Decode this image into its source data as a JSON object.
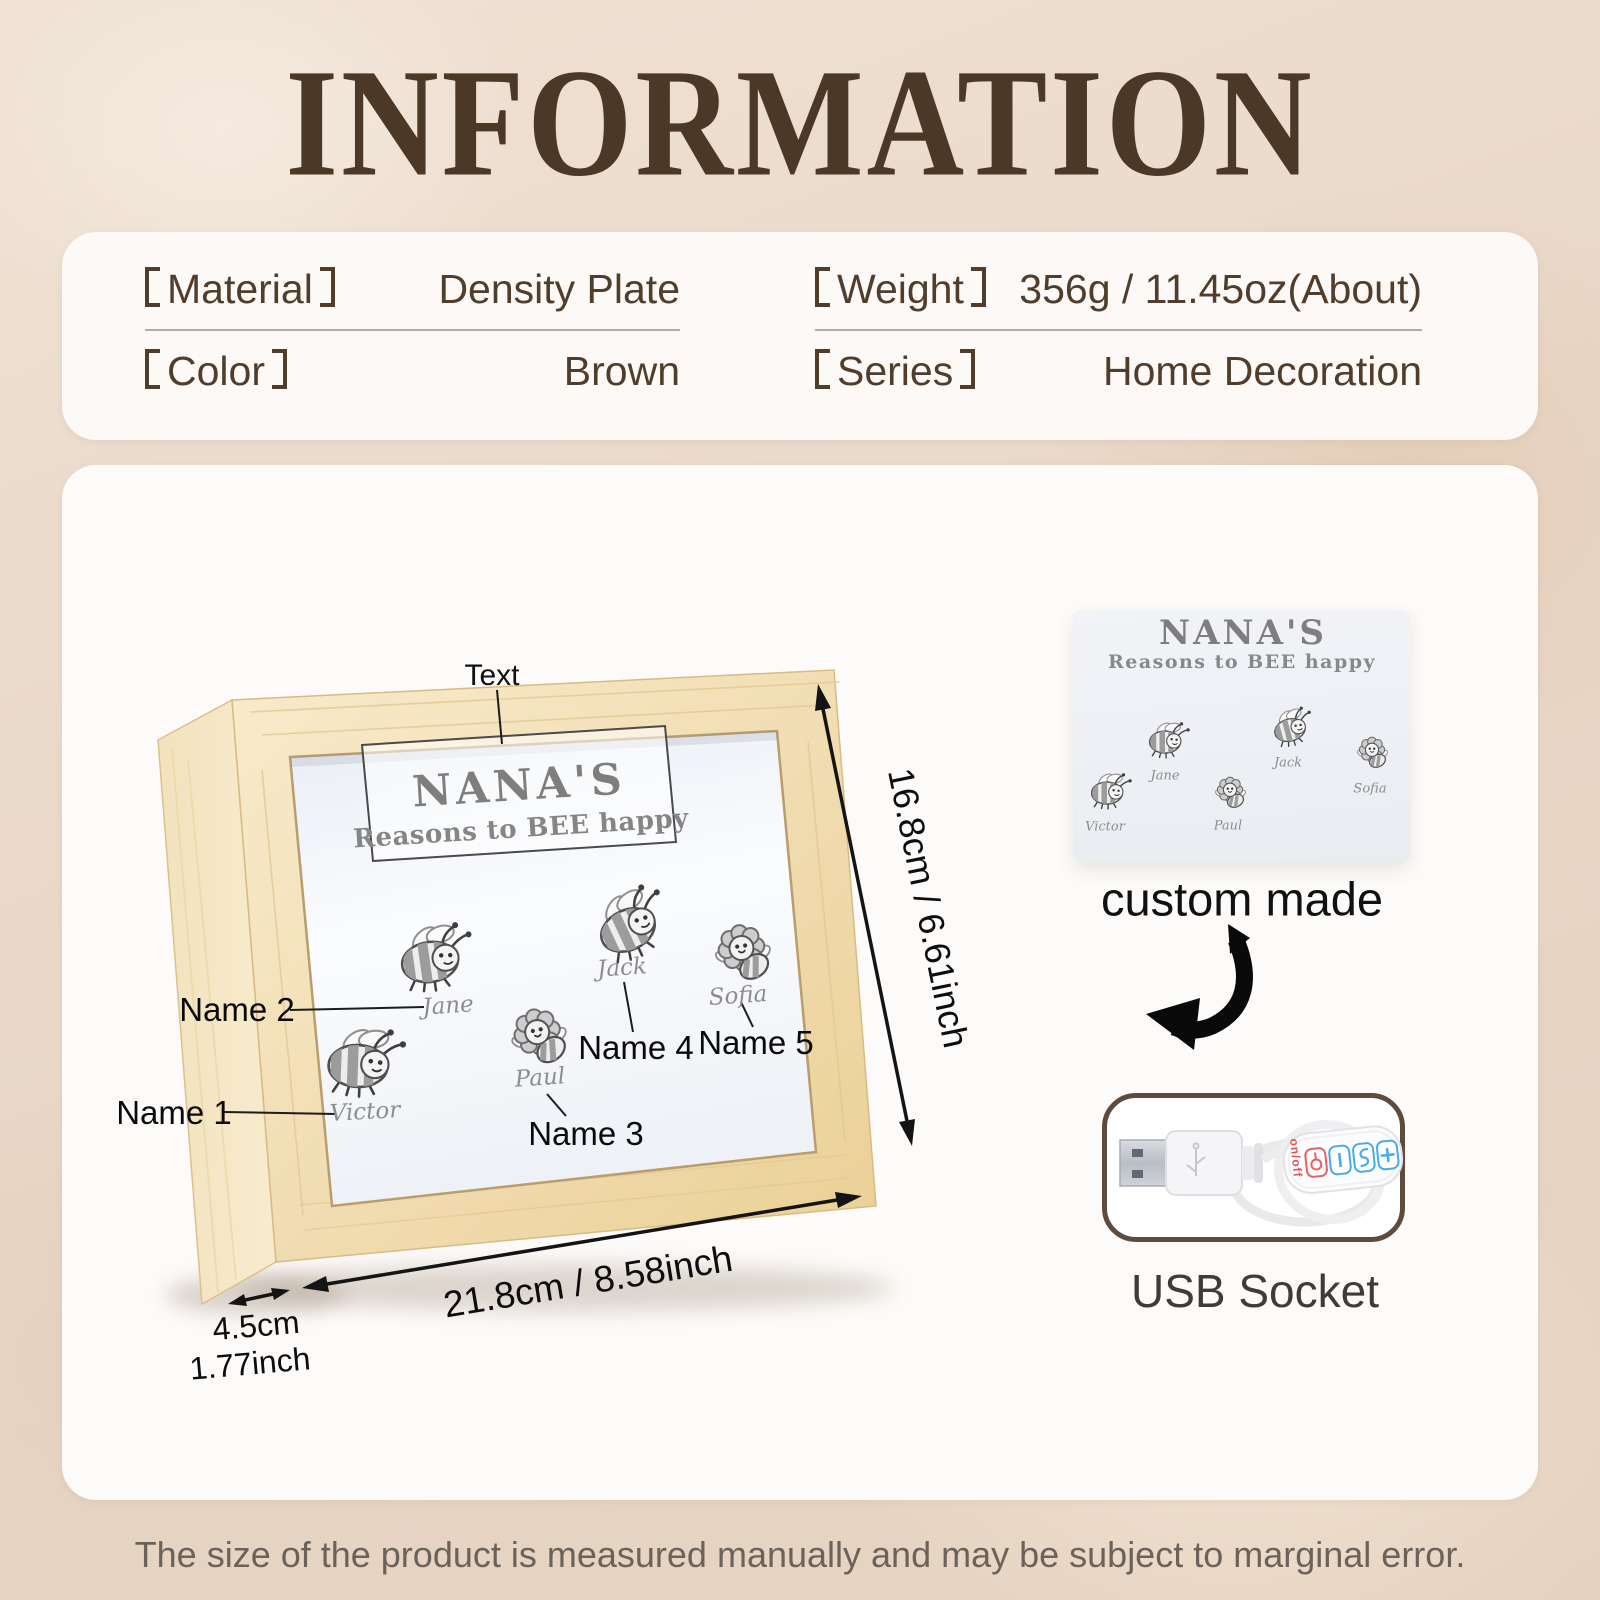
{
  "page": {
    "title": "INFORMATION"
  },
  "specs": {
    "left": [
      {
        "label": "Material",
        "value": "Density Plate"
      },
      {
        "label": "Color",
        "value": "Brown"
      }
    ],
    "right": [
      {
        "label": "Weight",
        "value": "356g / 11.45oz(About)"
      },
      {
        "label": "Series",
        "value": "Home Decoration"
      }
    ]
  },
  "diagram": {
    "pointer_label": "Text",
    "plaque": {
      "title": "NANA'S",
      "subtitle": "Reasons to BEE happy"
    },
    "bees": [
      {
        "name": "Victor",
        "label": "Name 1",
        "type": "bee"
      },
      {
        "name": "Jane",
        "label": "Name 2",
        "type": "bee"
      },
      {
        "name": "Paul",
        "label": "Name 3",
        "type": "flower-bee"
      },
      {
        "name": "Jack",
        "label": "Name 4",
        "type": "bee"
      },
      {
        "name": "Sofia",
        "label": "Name 5",
        "type": "flower-bee"
      }
    ],
    "dimensions": {
      "height": "16.8cm / 6.61inch",
      "width": "21.8cm / 8.58inch",
      "depth_cm": "4.5cm",
      "depth_inch": "1.77inch"
    }
  },
  "custom": {
    "caption": "custom made",
    "plaque_title": "NANA'S",
    "plaque_subtitle": "Reasons to BEE happy"
  },
  "usb": {
    "caption": "USB Socket",
    "remote": {
      "onoff_label": "on/off",
      "button_icons": [
        "power-icon",
        "minus-icon",
        "mode-icon",
        "plus-icon"
      ]
    }
  },
  "footer": {
    "disclaimer": "The size of the product is measured manually and may be subject to marginal error."
  },
  "colors": {
    "accent_brown": "#4c3827",
    "wood": "#f2deba",
    "background": "#e9d9cb",
    "button_blue": "#46abe8",
    "button_red": "#e05552"
  }
}
